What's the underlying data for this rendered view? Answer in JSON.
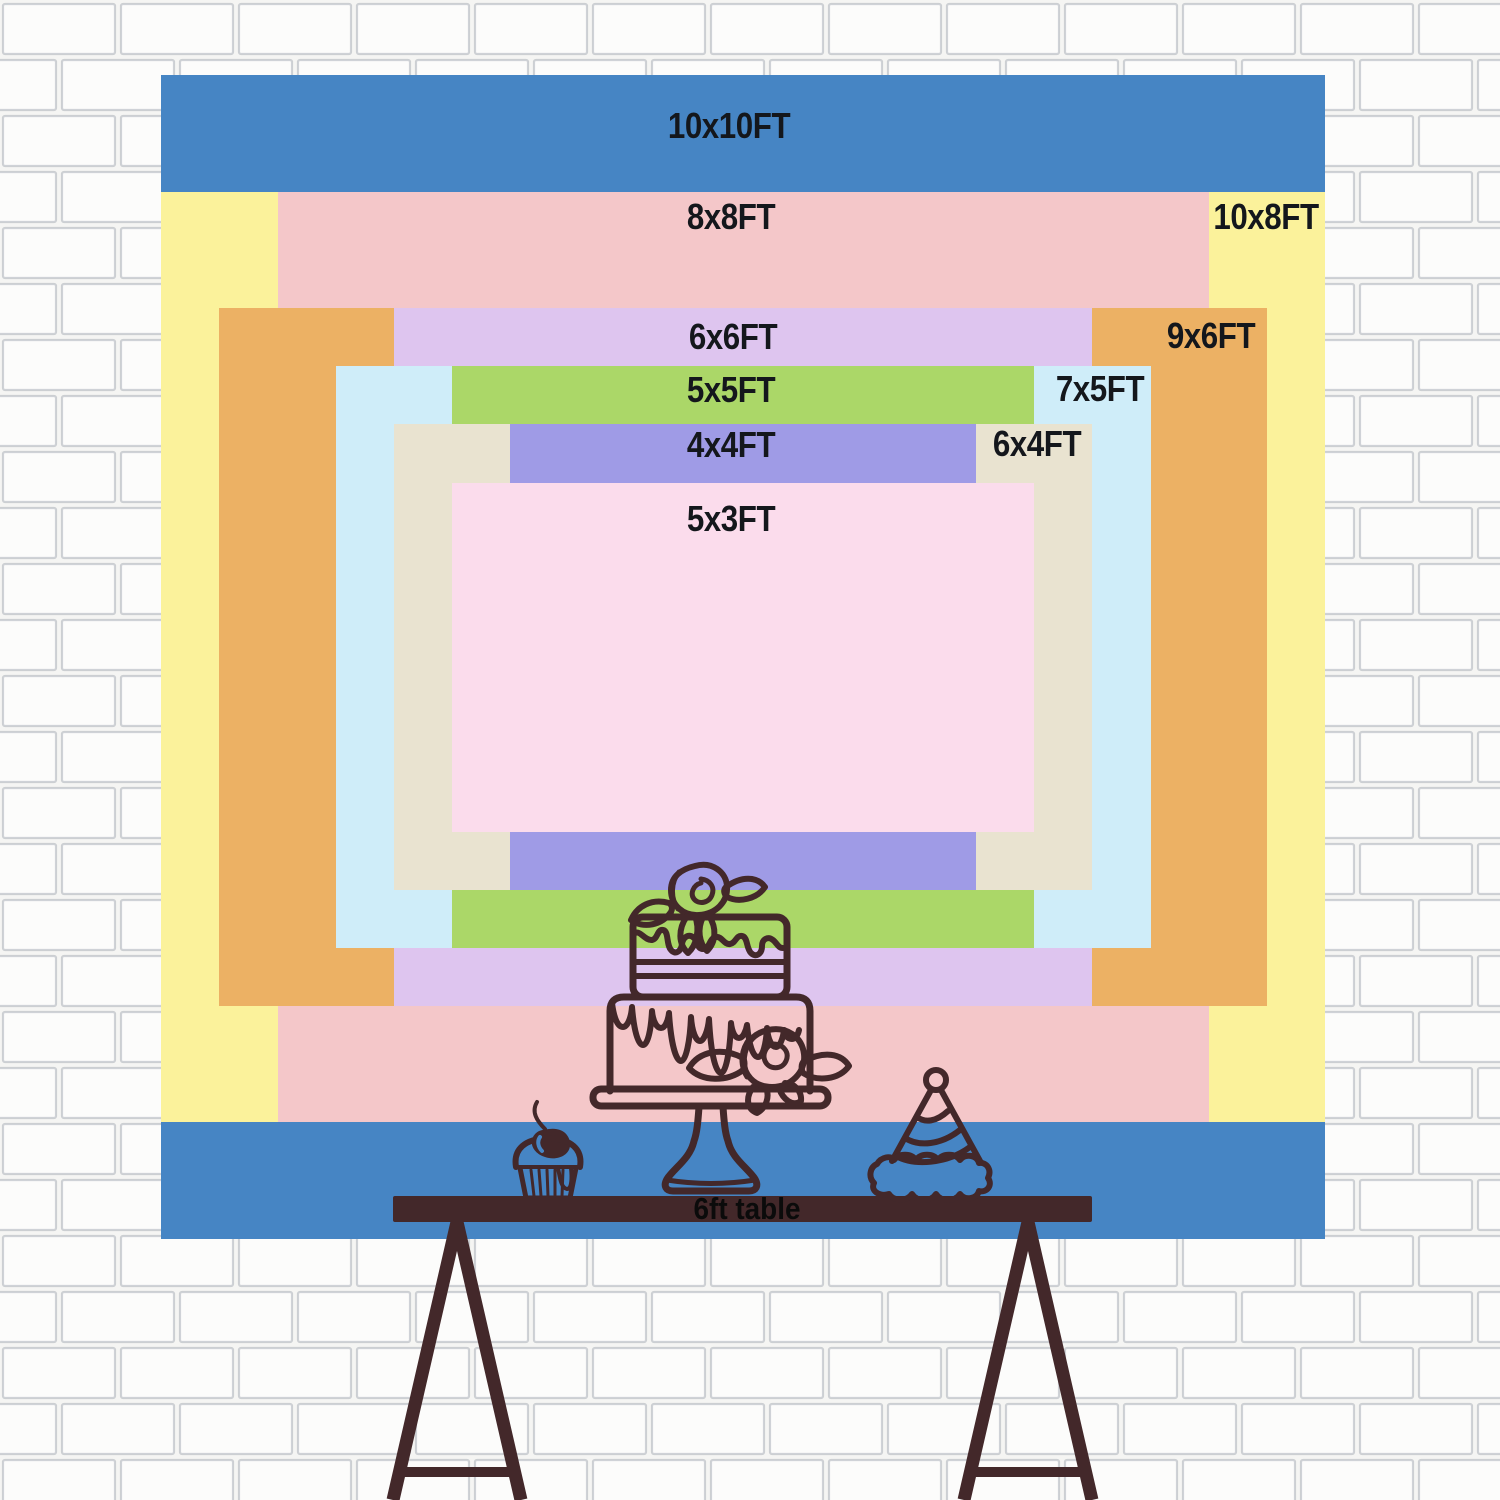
{
  "sizes": [
    {
      "id": "10x10",
      "label": "10x10FT",
      "color": "#4685C4"
    },
    {
      "id": "10x8",
      "label": "10x8FT",
      "color": "#FBF29B"
    },
    {
      "id": "8x8",
      "label": "8x8FT",
      "color": "#F4C7C9"
    },
    {
      "id": "9x6",
      "label": "9x6FT",
      "color": "#ECB164"
    },
    {
      "id": "6x6",
      "label": "6x6FT",
      "color": "#DEC5EF"
    },
    {
      "id": "7x5",
      "label": "7x5FT",
      "color": "#CFEDF9"
    },
    {
      "id": "5x5",
      "label": "5x5FT",
      "color": "#ABD768"
    },
    {
      "id": "6x4",
      "label": "6x4FT",
      "color": "#E9E3D0"
    },
    {
      "id": "4x4",
      "label": "4x4FT",
      "color": "#9F9BE6"
    },
    {
      "id": "5x3",
      "label": "5x3FT",
      "color": "#FBDCEC"
    }
  ],
  "table": {
    "label": "6ft table",
    "color": "#43282A"
  },
  "art": {
    "line_color": "#43282A",
    "icons": [
      "cake-icon",
      "cupcake-icon",
      "cherry-icon",
      "party-hat-icon",
      "trestle-table-icon"
    ]
  },
  "label_text_color": "#14171C"
}
